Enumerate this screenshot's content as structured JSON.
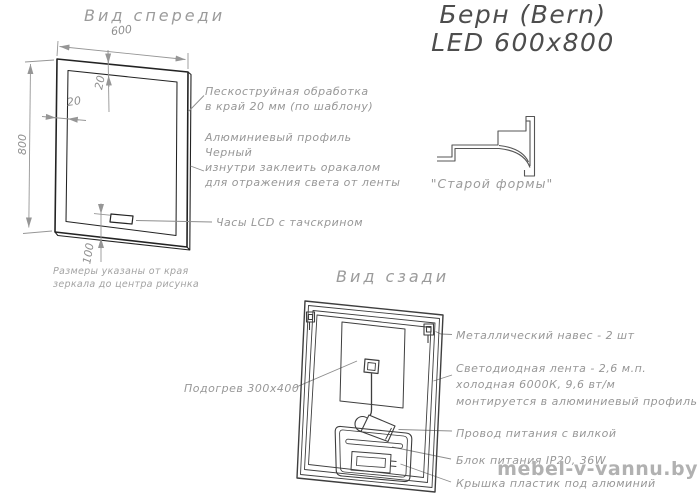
{
  "title": {
    "line1": "Берн (Bern)",
    "line2": "LED 600x800"
  },
  "front_view": {
    "label": "Вид спереди",
    "dimensions": {
      "width": "600",
      "height": "800",
      "sandblast_offset_top": "20",
      "sandblast_offset_left": "20",
      "clock_offset": "100"
    },
    "note_line1": "Размеры указаны от края",
    "note_line2": "зеркала до центра рисунка",
    "annotations": {
      "sandblast_line1": "Пескоструйная обработка",
      "sandblast_line2": "в край 20 мм (по шаблону)",
      "profile_line1": "Алюминиевый профиль",
      "profile_line2": "Черный",
      "profile_line3": "изнутри заклеить оракалом",
      "profile_line4": "для отражения света от ленты",
      "clock": "Часы LCD с тачскрином"
    }
  },
  "profile_detail": {
    "caption": "\"Старой формы\""
  },
  "back_view": {
    "label": "Вид сзади",
    "annotations": {
      "heater": "Подогрев 300x400",
      "hangers": "Металлический навес - 2 шт",
      "led_line1": "Светодиодная лента - 2,6 м.п.",
      "led_line2": "холодная 6000К, 9,6 вт/м",
      "led_line3": "монтируется в алюминиевый профиль",
      "power_cord": "Провод питания с вилкой",
      "power_supply": "Блок питания IP20, 36W",
      "cover": "Крышка пластик под алюминий"
    }
  },
  "watermark": "mebel-v-vannu.by",
  "colors": {
    "front_lines": "#232323",
    "back_lines": "#3e3e3e",
    "dimension_gray": "#969696",
    "leader_gray": "#8d8d8d",
    "annotation_text": "#979797",
    "title_text": "#4d4d4d",
    "watermark_gray": "#b1b1b1"
  }
}
